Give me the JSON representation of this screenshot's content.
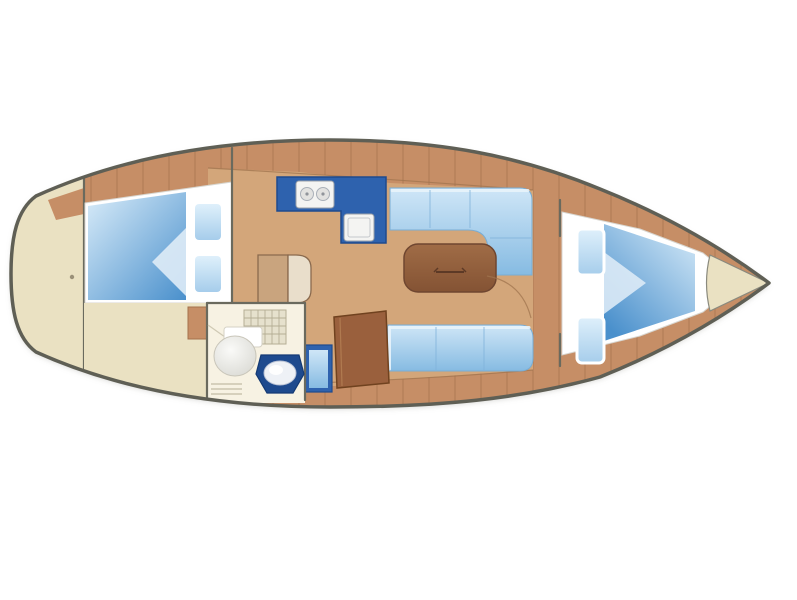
{
  "meta": {
    "title": "Sailing yacht interior layout plan (top view, bow to the right)",
    "diagram_type": "boat-floor-plan",
    "text_on_image": "none"
  },
  "colors": {
    "background": "#ffffff",
    "hull_line": "#5f5f55",
    "plank": "#c68e66",
    "plank_seam": "#a4714c",
    "floor": "#d3a67a",
    "beige": "#eae1c2",
    "head_floor": "#f7f2e3",
    "wall": "#6a6a5e",
    "navy": "#2e62ae",
    "navy_dark": "#1e4a8e",
    "settee_light": "#cfe6f7",
    "settee_mid": "#86bbe2",
    "quilt_light": "#d9ecf9",
    "quilt_deep": "#4a90cc",
    "quilt_fold": "#dceaf6",
    "pillow_light": "#dff0fb",
    "pillow_mid": "#a6cdeb",
    "white": "#ffffff",
    "table_light": "#a06c46",
    "table_dark": "#845334",
    "chart_brown": "#9a603d",
    "steps_tan": "#c9a47e",
    "steps_light": "#e9decb",
    "fixture_white": "#f4f4f2",
    "fixture_edge": "#9aa0a8",
    "burner": "#e2e2e0",
    "grate": "#e6e1cd",
    "toilet_white": "#fafaf8",
    "bowl_shade": "#d8d8d2",
    "sink_bowl": "#eef1f6"
  },
  "features": [
    {
      "id": "stern-lazarette",
      "label": "Stern / lazarette area"
    },
    {
      "id": "aft-double-cabin",
      "label": "Aft double cabin with berth and two pillows"
    },
    {
      "id": "companionway-steps",
      "label": "Companionway steps"
    },
    {
      "id": "galley",
      "label": "L-shaped galley with stove and sink"
    },
    {
      "id": "saloon",
      "label": "Saloon"
    },
    {
      "id": "l-settee",
      "label": "Starboard L-shaped settee"
    },
    {
      "id": "saloon-table",
      "label": "Folding saloon table"
    },
    {
      "id": "port-settee",
      "label": "Port straight settee"
    },
    {
      "id": "chart-table",
      "label": "Chart table / navigation locker"
    },
    {
      "id": "head",
      "label": "Head (bathroom) with toilet, washbasin and shower grate"
    },
    {
      "id": "forward-v-berth",
      "label": "Forward V-berth cabin with two pillows"
    },
    {
      "id": "anchor-locker",
      "label": "Bow anchor locker"
    }
  ]
}
